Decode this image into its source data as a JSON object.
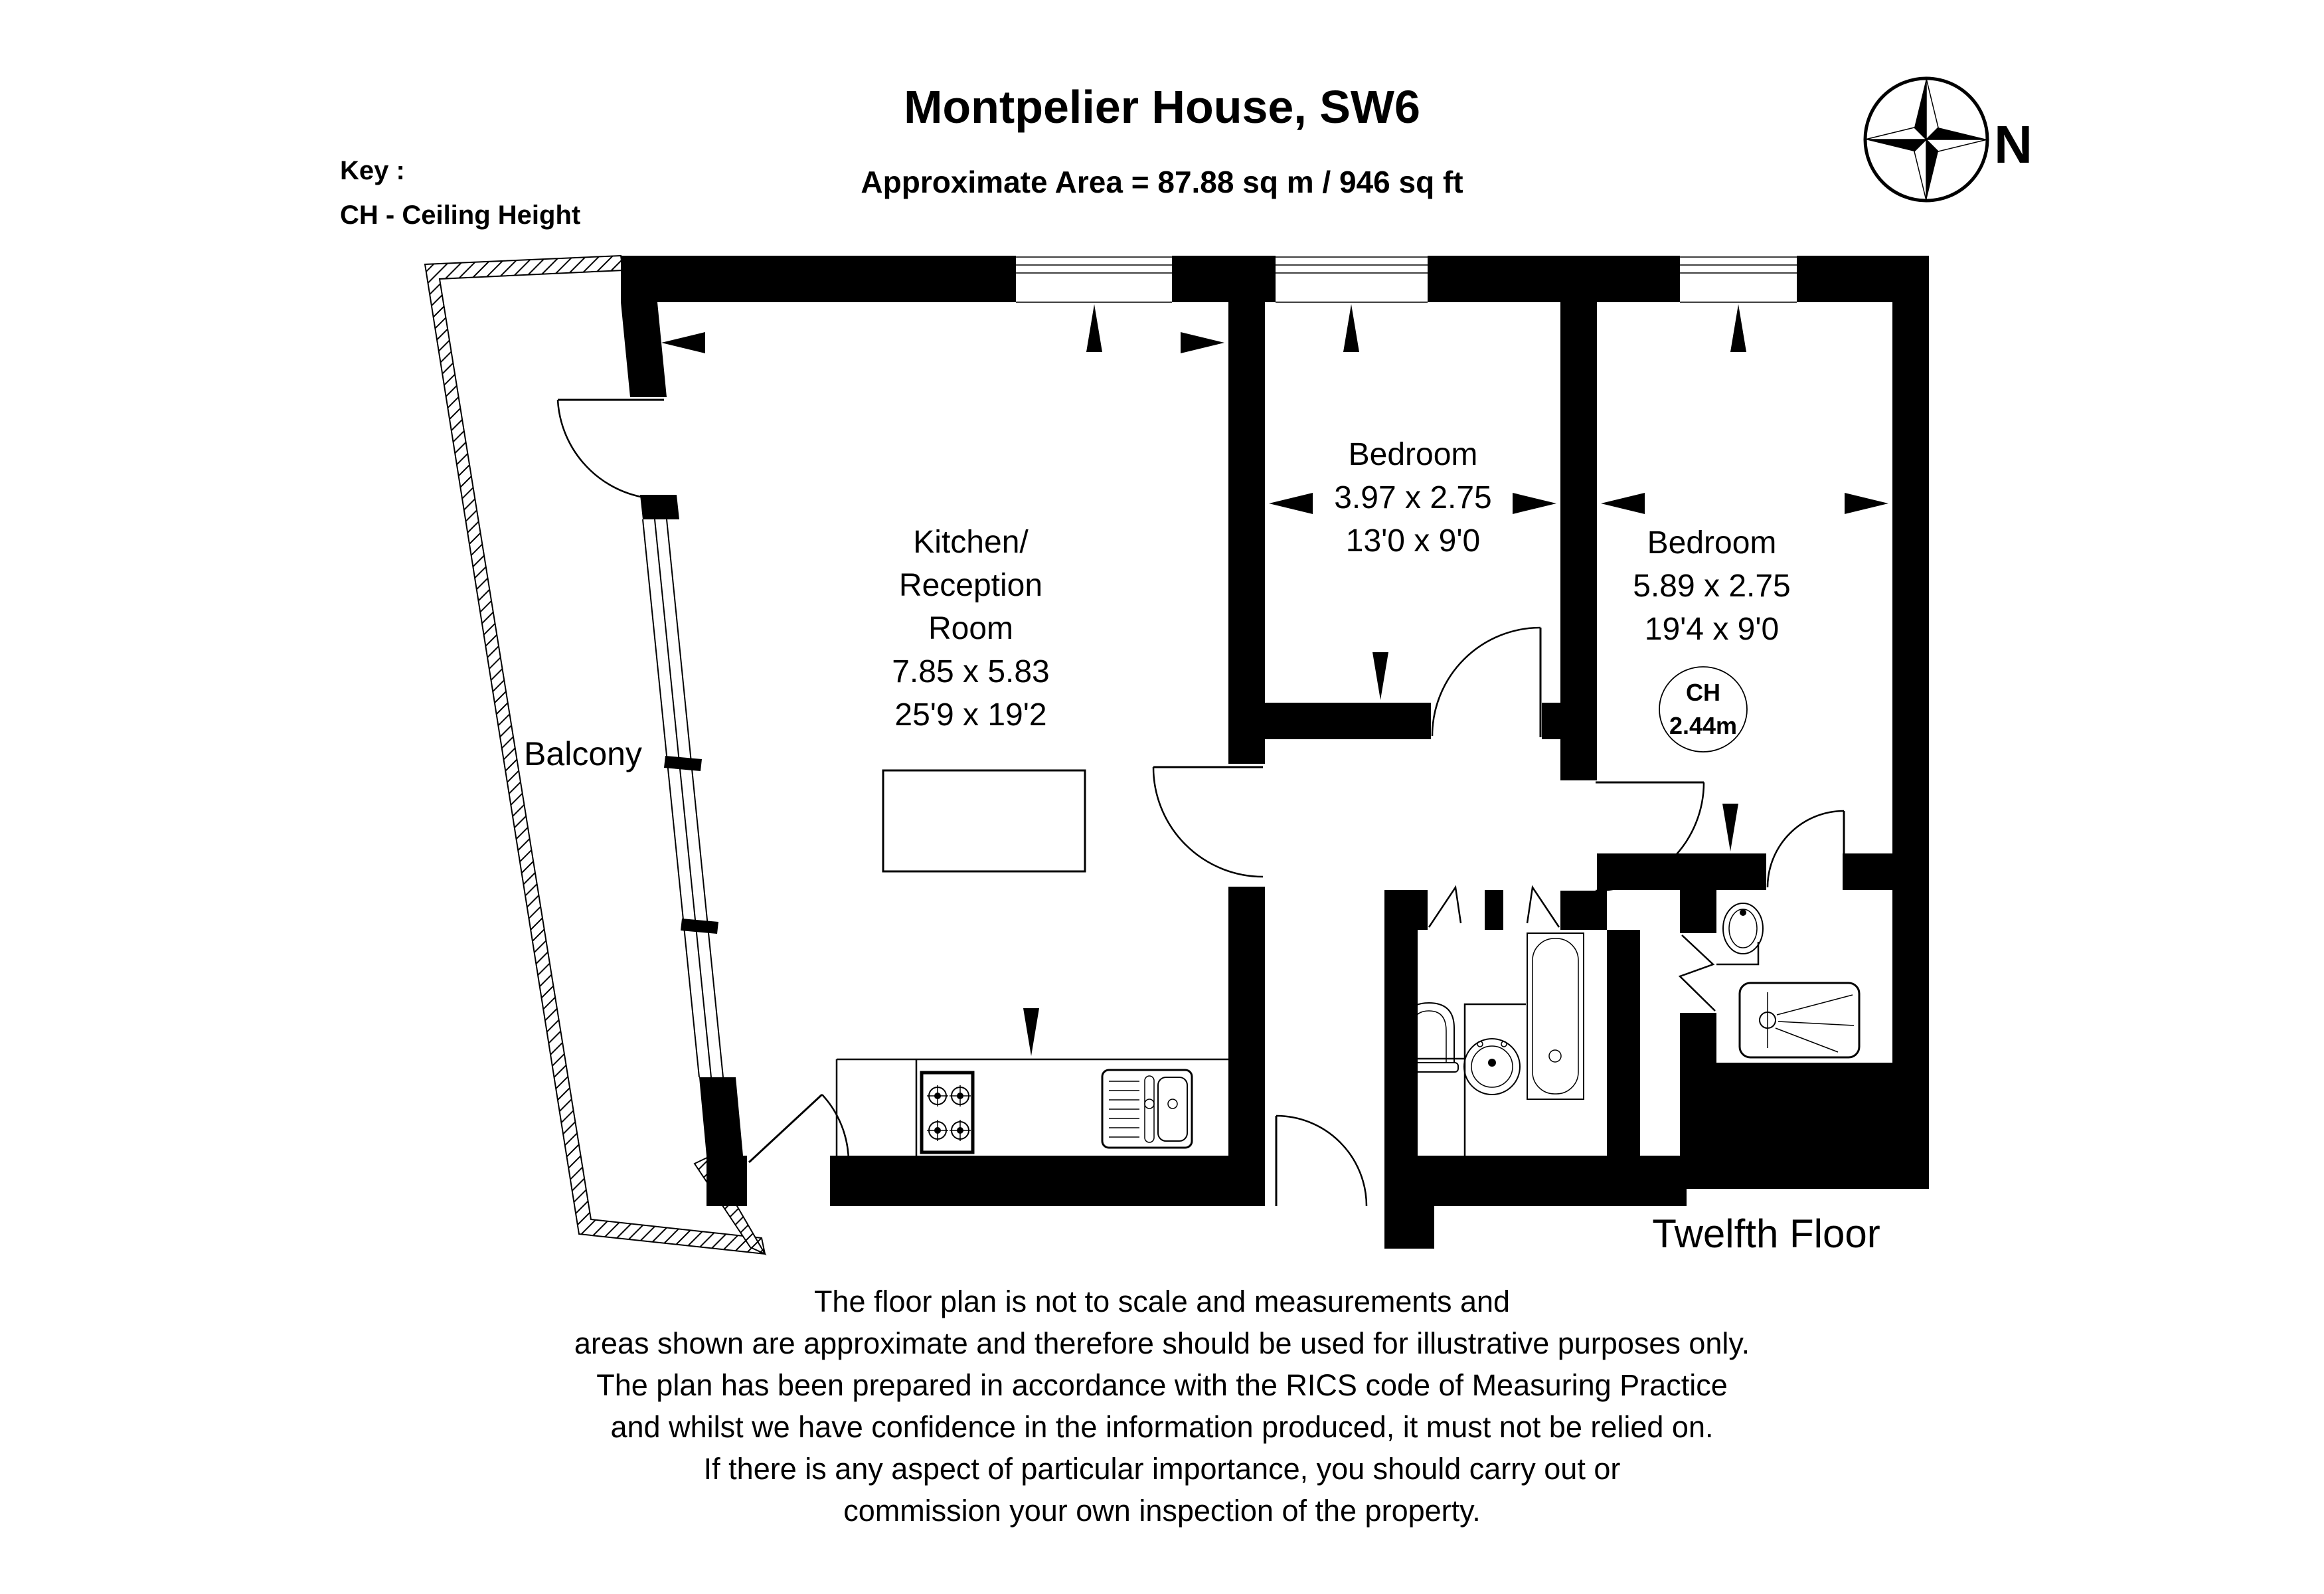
{
  "page": {
    "title": "Montpelier House, SW6",
    "area_label": "Approximate Area =  87.88 sq m / 946 sq ft",
    "floor_label": "Twelfth Floor"
  },
  "key": {
    "heading": "Key :",
    "ceiling_height": "CH - Ceiling Height"
  },
  "compass": {
    "north_label": "N"
  },
  "rooms": {
    "balcony": {
      "name": "Balcony"
    },
    "kitchen_reception": {
      "name_lines": [
        "Kitchen/",
        "Reception",
        "Room"
      ],
      "dimensions_metric": "7.85 x 5.83",
      "dimensions_imperial": "25'9 x 19'2"
    },
    "bedroom_1": {
      "name": "Bedroom",
      "dimensions_metric": "3.97 x 2.75",
      "dimensions_imperial": "13'0 x 9'0"
    },
    "bedroom_2": {
      "name": "Bedroom",
      "dimensions_metric": "5.89 x 2.75",
      "dimensions_imperial": "19'4 x 9'0",
      "ceiling_height": {
        "label": "CH",
        "value": "2.44m"
      }
    }
  },
  "disclaimer": {
    "lines": [
      "The floor plan is not to scale and measurements and",
      "areas shown are approximate and therefore should be used for illustrative purposes only.",
      "The plan has been prepared in accordance with the RICS code of Measuring Practice",
      "and whilst we have confidence in the information produced, it must not be relied on.",
      "If there is any aspect of particular importance, you should carry out or",
      "commission your own inspection of the property."
    ]
  },
  "colors": {
    "walls": "#000000",
    "background": "#ffffff",
    "text": "#000000"
  }
}
